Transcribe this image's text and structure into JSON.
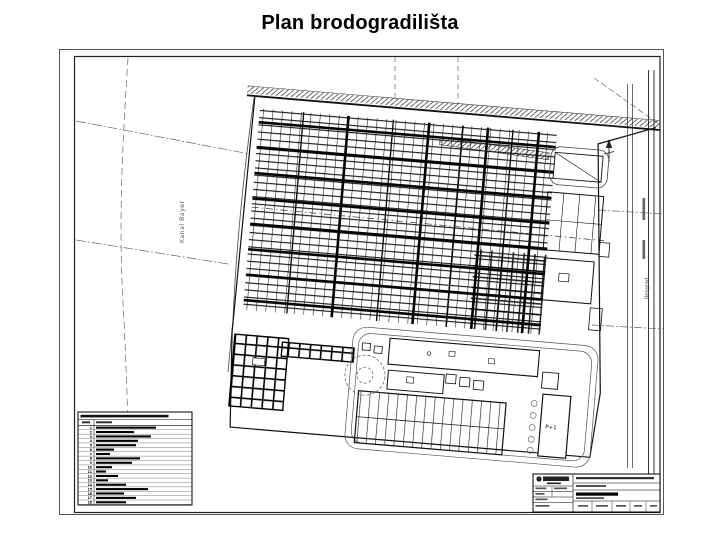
{
  "slide": {
    "title": "Plan brodogradilišta"
  },
  "drawing": {
    "canal_label": "Kanal Bayer",
    "road_label": "Beograd",
    "building_label": "P+1",
    "icons": {
      "north_arrow": "↑"
    }
  },
  "legend": {
    "rows": [
      {
        "n": "1",
        "w": 60
      },
      {
        "n": "2",
        "w": 38
      },
      {
        "n": "3",
        "w": 55
      },
      {
        "n": "4",
        "w": 42
      },
      {
        "n": "5",
        "w": 40
      },
      {
        "n": "6",
        "w": 18
      },
      {
        "n": "7",
        "w": 14
      },
      {
        "n": "8",
        "w": 44
      },
      {
        "n": "9",
        "w": 36
      },
      {
        "n": "10",
        "w": 16
      },
      {
        "n": "11",
        "w": 10
      },
      {
        "n": "12",
        "w": 22
      },
      {
        "n": "13",
        "w": 12
      },
      {
        "n": "14",
        "w": 30
      },
      {
        "n": "15",
        "w": 52
      },
      {
        "n": "16",
        "w": 28
      },
      {
        "n": "17",
        "w": 40
      },
      {
        "n": "18",
        "w": 30
      }
    ]
  }
}
